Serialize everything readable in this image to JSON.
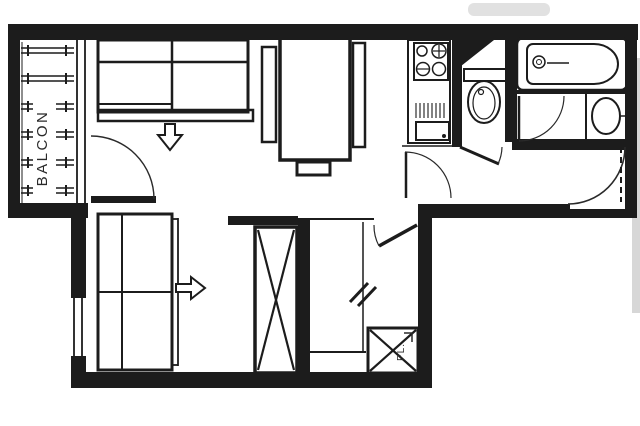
{
  "plan": {
    "type": "apartment-floor-plan",
    "labels": {
      "balcony": "BALCON",
      "closet": "PL."
    },
    "colors": {
      "ink": "#1c1c1c",
      "paper": "#ffffff",
      "scan_gray": "#c9c9c9"
    },
    "annotations": {
      "sofa_arrow_direction": "down",
      "bed_arrow_direction": "right"
    },
    "fixtures": [
      "balcony-railing",
      "sofa-bed",
      "dining-table",
      "chair",
      "chair",
      "stool",
      "kitchen-unit",
      "stove-burners",
      "toilet",
      "bathtub",
      "washbasin",
      "twin-bed",
      "wardrobe-cross",
      "bunk-bed",
      "closet-cross",
      "balcony-door",
      "kitchen-door",
      "wc-door",
      "bathroom-door",
      "entry-door",
      "cabin-door"
    ]
  }
}
